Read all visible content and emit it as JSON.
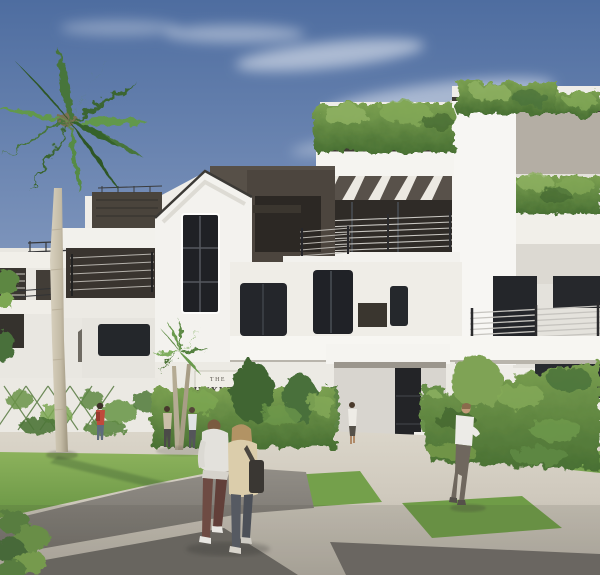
{
  "scene": {
    "type": "architectural-rendering-photo",
    "description": "Sunny architectural rendering of The Huxley, a white three-story luxury condominium with bronze metal accents, rooftop hedges and terraces, a tall royal palm, landscaped ivy hedges, lawn panels and pedestrians walking on a paved plaza street",
    "sign": {
      "line1": "THE",
      "line2": "HUXLEY"
    },
    "pedestrians": {
      "count": 7,
      "foreground": "couple walking away (man in light sweater and maroon pants, woman in beige jacket with dark shoulder bag)",
      "right": "man in white shirt and gray trousers",
      "left": "person with red backpack on sidewalk",
      "near_building": "residents by the small palm and entrance steps"
    },
    "palette": {
      "sky_top": "#4e6da0",
      "sky_horizon": "#c9d2de",
      "facade_white": "#f4f3ef",
      "facade_shadow": "#ddd9d2",
      "bronze_metal": "#4c453e",
      "window_glass": "#23262b",
      "railing_metal": "#303134",
      "foliage_green": "#6a8f48",
      "foliage_light": "#8fb261",
      "lawn_green": "#7fa851",
      "concrete_paving": "#d7d2c6",
      "asphalt": "#827e78",
      "palm_trunk": "#cdc5b2"
    }
  }
}
